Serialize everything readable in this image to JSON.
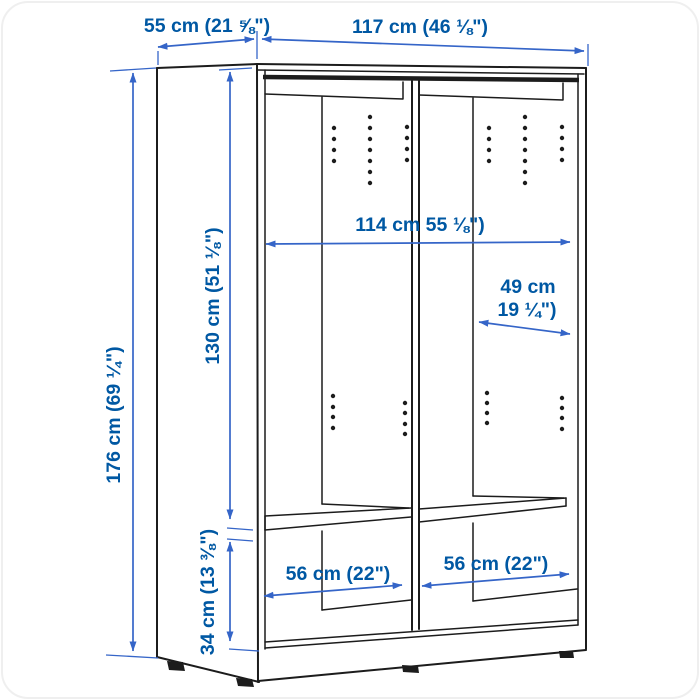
{
  "colors": {
    "outline": "#1c1c1c",
    "dimension_line": "#3565c8",
    "dimension_text": "#0058a3",
    "background": "#ffffff"
  },
  "dimensions": {
    "depth": {
      "label": "55 cm (21 ⅝\")"
    },
    "width": {
      "label": "117 cm (46 ⅛\")"
    },
    "height": {
      "label": "176 cm (69 ¼\")"
    },
    "interior_height_upper": {
      "label": "130 cm (51 ⅛\")"
    },
    "interior_width": {
      "label": "114 cm 55 ⅛\")"
    },
    "interior_depth": {
      "line1": "49 cm",
      "line2": "19 ¼\")"
    },
    "interior_height_lower": {
      "label": "34 cm (13 ⅜\")"
    },
    "left_compartment_width": {
      "label": "56 cm (22\")"
    },
    "right_compartment_width": {
      "label": "56 cm (22\")"
    }
  }
}
